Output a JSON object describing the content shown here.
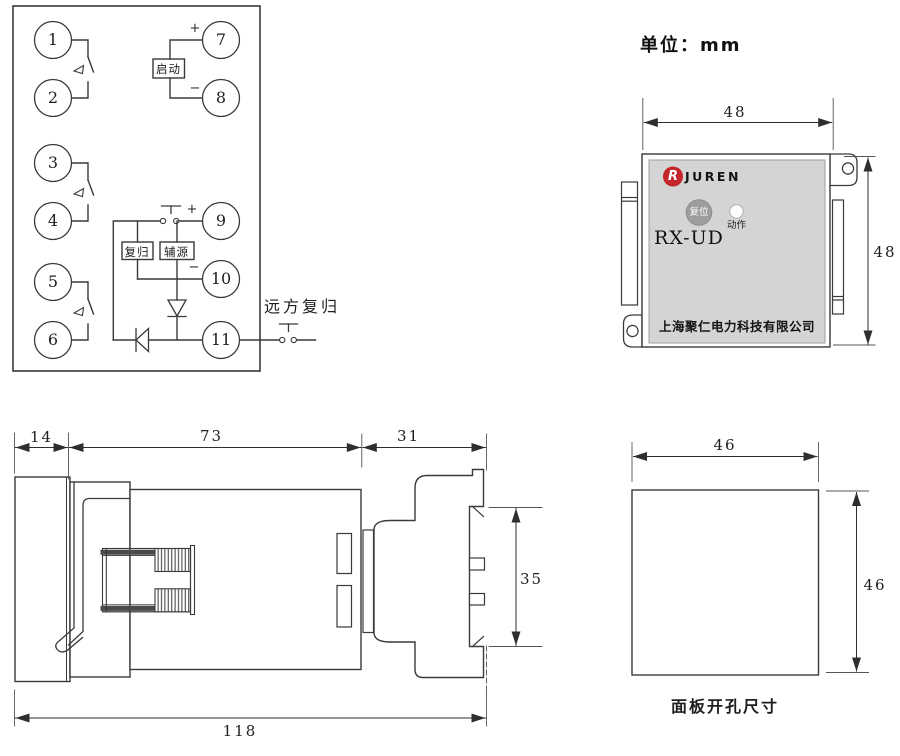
{
  "unit_label": "单位：mm",
  "terminal_diagram": {
    "terminals": [
      "1",
      "2",
      "3",
      "4",
      "5",
      "6",
      "7",
      "8",
      "9",
      "10",
      "11"
    ],
    "start_box": "启动",
    "reset_box": "复归",
    "aux_box": "辅源",
    "remote_reset_label": "远方复归",
    "plus": "+",
    "minus": "−"
  },
  "front_panel": {
    "brand": "JUREN",
    "logo_letter": "R",
    "reset_button": "复位",
    "action_indicator": "动作",
    "model": "RX-UD",
    "company": "上海聚仁电力科技有限公司",
    "width_dim": "48",
    "height_dim": "48",
    "accent_red": "#c5262c",
    "panel_gray": "#d4d4d4",
    "button_gray": "#9d9d9d"
  },
  "side_view": {
    "front_depth": "14",
    "body_depth": "73",
    "rear_depth": "31",
    "total_depth": "118",
    "rear_height": "35"
  },
  "cutout": {
    "width_dim": "46",
    "height_dim": "46",
    "caption": "面板开孔尺寸"
  }
}
